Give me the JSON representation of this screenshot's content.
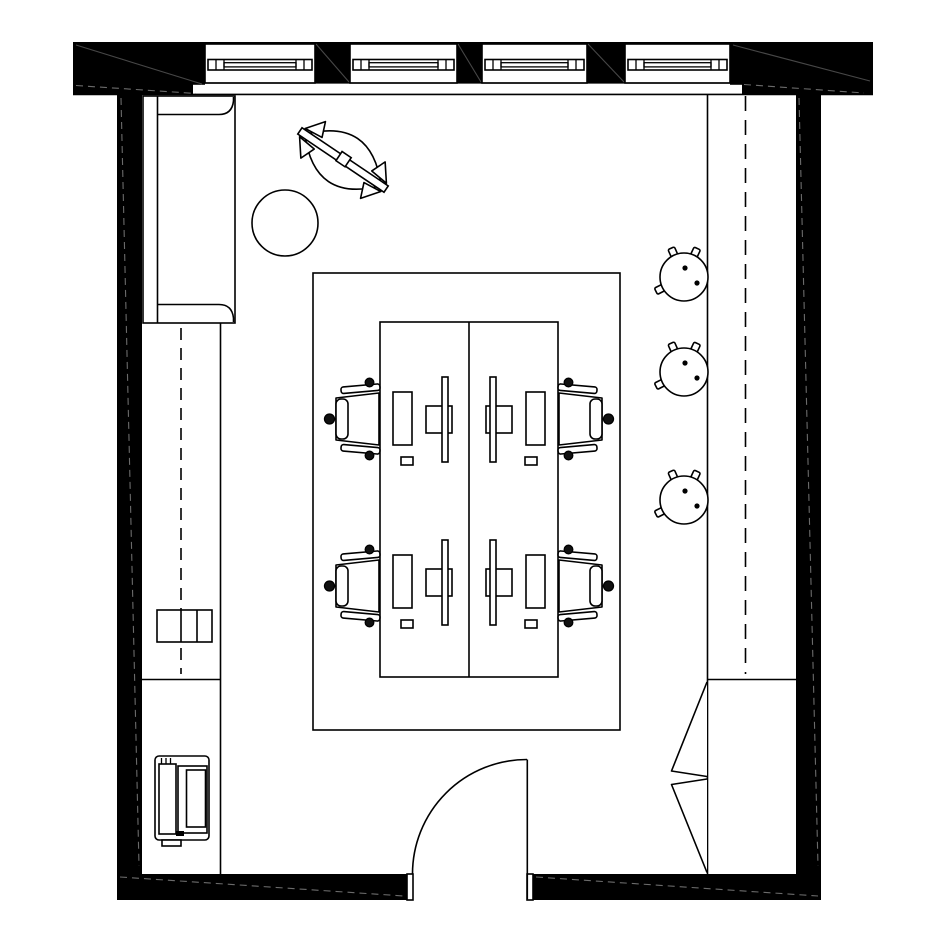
{
  "meta": {
    "title": "Office room floor plan",
    "drawing_type": "architectural top-view floor plan",
    "colors": {
      "background": "#ffffff",
      "wall_fill": "#000000",
      "line": "#000000",
      "hatch": "#555555"
    }
  },
  "structure": {
    "exterior_walls": {
      "label": "Exterior walls (solid black)"
    },
    "corner_columns": {
      "label": "Corner wall column",
      "count": 2
    },
    "window_piers": {
      "label": "Window pier",
      "count": 3
    },
    "windows": {
      "label": "Window with glazing band",
      "count": 4
    },
    "entry_door": {
      "label": "Single swing entry door with 90-degree arc"
    },
    "partition_line": {
      "label": "Interior partition line (right side)"
    },
    "overhead_dashed": {
      "label": "Dashed overhead element line (right side)"
    },
    "counter_dashed": {
      "label": "Dashed centerline of left counter run"
    }
  },
  "furniture": {
    "sofa": {
      "label": "Sofa against left wall",
      "count": 1
    },
    "lounge_chair": {
      "label": "Rotated lounge chair",
      "count": 1
    },
    "side_table": {
      "label": "Round side table",
      "count": 1
    },
    "work_rug": {
      "label": "Work area boundary / rug outline",
      "count": 1
    },
    "desk_bench": {
      "label": "Back-to-back desk bench",
      "desks": 2,
      "workstations": 4
    },
    "monitor": {
      "label": "Monitor with stand",
      "count": 4
    },
    "keyboard": {
      "label": "Keyboard",
      "count": 4
    },
    "mouse": {
      "label": "Mouse",
      "count": 4
    },
    "task_chair": {
      "label": "Office task chair",
      "count": 4
    },
    "stool": {
      "label": "Round stool",
      "count": 3
    },
    "counter": {
      "label": "Left counter / cabinet run",
      "count": 1
    },
    "drawer_cabinet": {
      "label": "Three-section drawer cabinet",
      "count": 1
    },
    "printer": {
      "label": "Printer appliance",
      "count": 1
    },
    "wardrobe": {
      "label": "Corner wardrobe with bi-fold doors",
      "count": 1
    }
  }
}
